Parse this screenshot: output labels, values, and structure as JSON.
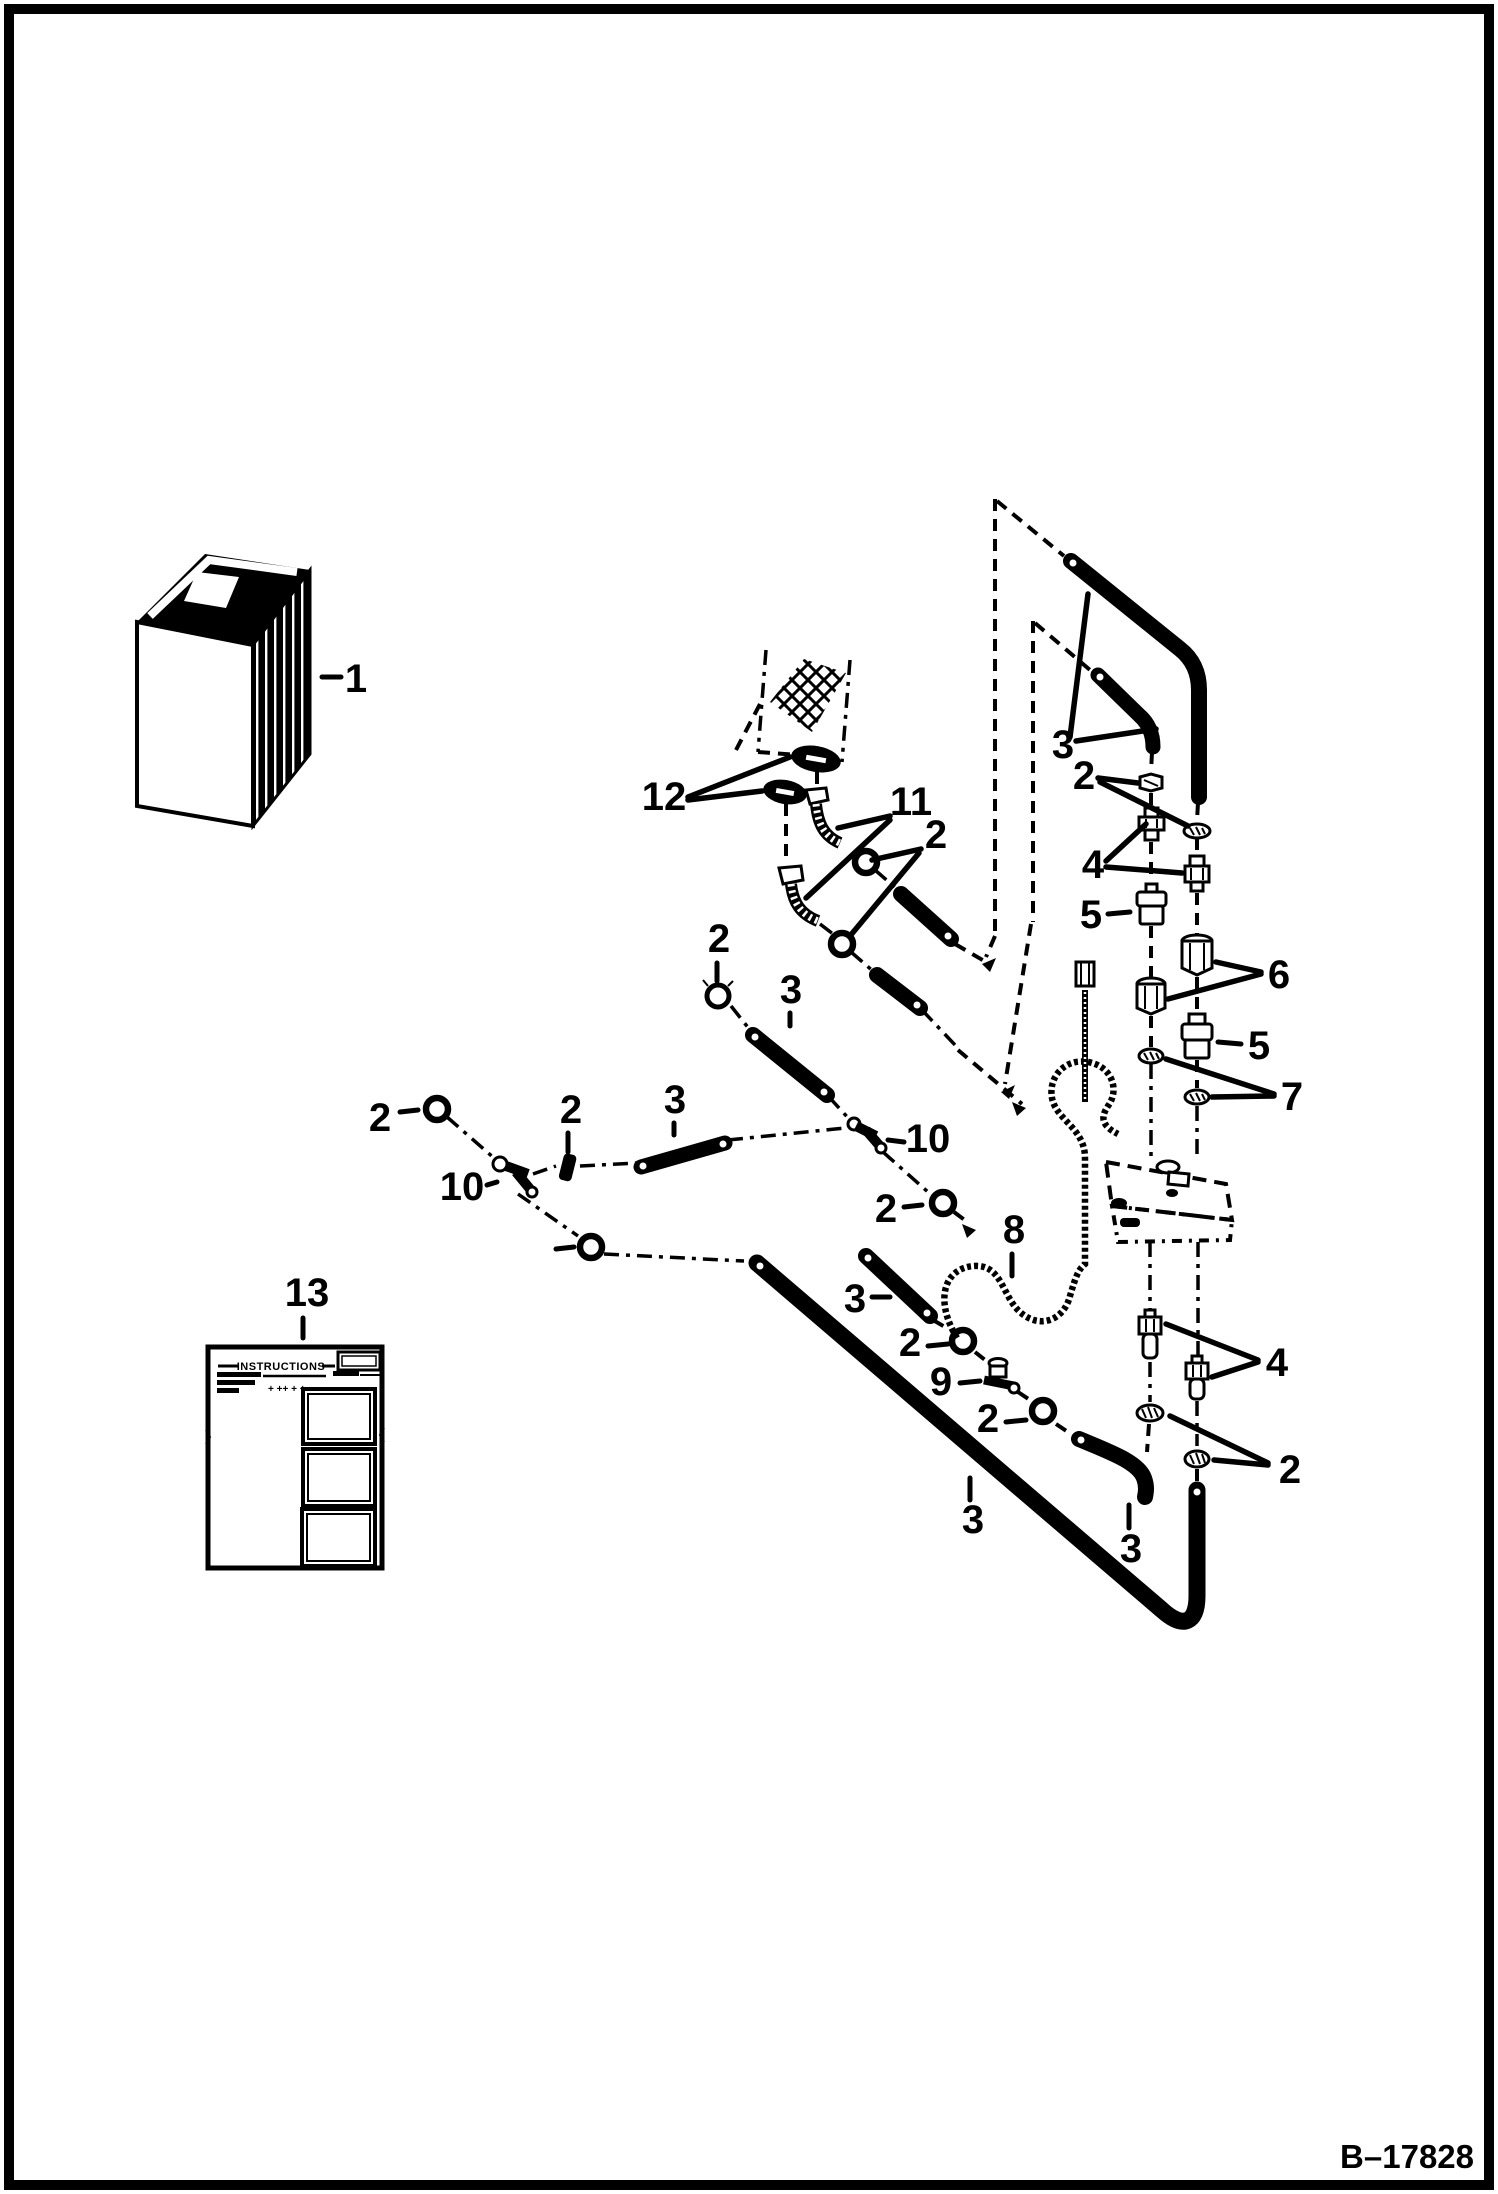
{
  "page": {
    "figure_number": "B–17828",
    "paper_color": "#ffffff",
    "ink_color": "#000000",
    "type": "exploded-parts-diagram"
  },
  "callouts": [
    {
      "id": "1",
      "label": "1",
      "x": 356,
      "y": 692
    },
    {
      "id": "12",
      "label": "12",
      "x": 664,
      "y": 810
    },
    {
      "id": "11",
      "label": "11",
      "x": 911,
      "y": 815
    },
    {
      "id": "2a",
      "label": "2",
      "x": 936,
      "y": 848
    },
    {
      "id": "3a",
      "label": "3",
      "x": 1063,
      "y": 758
    },
    {
      "id": "2b",
      "label": "2",
      "x": 1084,
      "y": 789
    },
    {
      "id": "4a",
      "label": "4",
      "x": 1093,
      "y": 878
    },
    {
      "id": "5a",
      "label": "5",
      "x": 1091,
      "y": 928
    },
    {
      "id": "6",
      "label": "6",
      "x": 1279,
      "y": 988
    },
    {
      "id": "5b",
      "label": "5",
      "x": 1259,
      "y": 1059
    },
    {
      "id": "7",
      "label": "7",
      "x": 1292,
      "y": 1110
    },
    {
      "id": "2c",
      "label": "2",
      "x": 719,
      "y": 952
    },
    {
      "id": "3b",
      "label": "3",
      "x": 791,
      "y": 1003
    },
    {
      "id": "2d",
      "label": "2",
      "x": 571,
      "y": 1123
    },
    {
      "id": "3c",
      "label": "3",
      "x": 675,
      "y": 1113
    },
    {
      "id": "2e",
      "label": "2",
      "x": 380,
      "y": 1131
    },
    {
      "id": "10a",
      "label": "10",
      "x": 462,
      "y": 1200
    },
    {
      "id": "10b",
      "label": "10",
      "x": 928,
      "y": 1152
    },
    {
      "id": "2f",
      "label": "2",
      "x": 886,
      "y": 1222
    },
    {
      "id": "8",
      "label": "8",
      "x": 1014,
      "y": 1243
    },
    {
      "id": "3d",
      "label": "3",
      "x": 855,
      "y": 1312
    },
    {
      "id": "2g",
      "label": "2",
      "x": 910,
      "y": 1356
    },
    {
      "id": "9",
      "label": "9",
      "x": 941,
      "y": 1395
    },
    {
      "id": "2h",
      "label": "2",
      "x": 988,
      "y": 1432
    },
    {
      "id": "3e",
      "label": "3",
      "x": 973,
      "y": 1533
    },
    {
      "id": "4b",
      "label": "4",
      "x": 1277,
      "y": 1376
    },
    {
      "id": "2i",
      "label": "2",
      "x": 1290,
      "y": 1483
    },
    {
      "id": "3f",
      "label": "3",
      "x": 1131,
      "y": 1562
    },
    {
      "id": "13",
      "label": "13",
      "x": 307,
      "y": 1306
    }
  ],
  "instruction_sheet": {
    "callout": "13",
    "title": "INSTRUCTIONS",
    "fine_print_marks": "+  ++ + +"
  }
}
